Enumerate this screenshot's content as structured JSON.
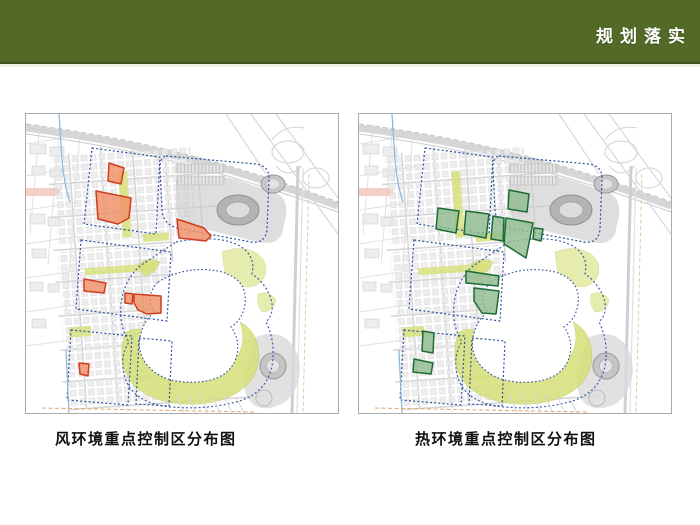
{
  "header": {
    "title": "规划落实"
  },
  "panels": [
    {
      "id": "wind",
      "caption": "风环境重点控制区分布图"
    },
    {
      "id": "thermal",
      "caption": "热环境重点控制区分布图"
    }
  ],
  "colors": {
    "header_bg": "#526927",
    "header_text": "#ffffff",
    "caption_text": "#111111",
    "wind_zone_fill": "#ef9166",
    "wind_zone_stroke": "#d13c22",
    "thermal_zone_fill": "#8fbc8f",
    "thermal_zone_stroke": "#1e6b35",
    "district_boundary": "#2b4fa3",
    "park_green": "#d6e077",
    "lake_fill": "#ffffff"
  }
}
